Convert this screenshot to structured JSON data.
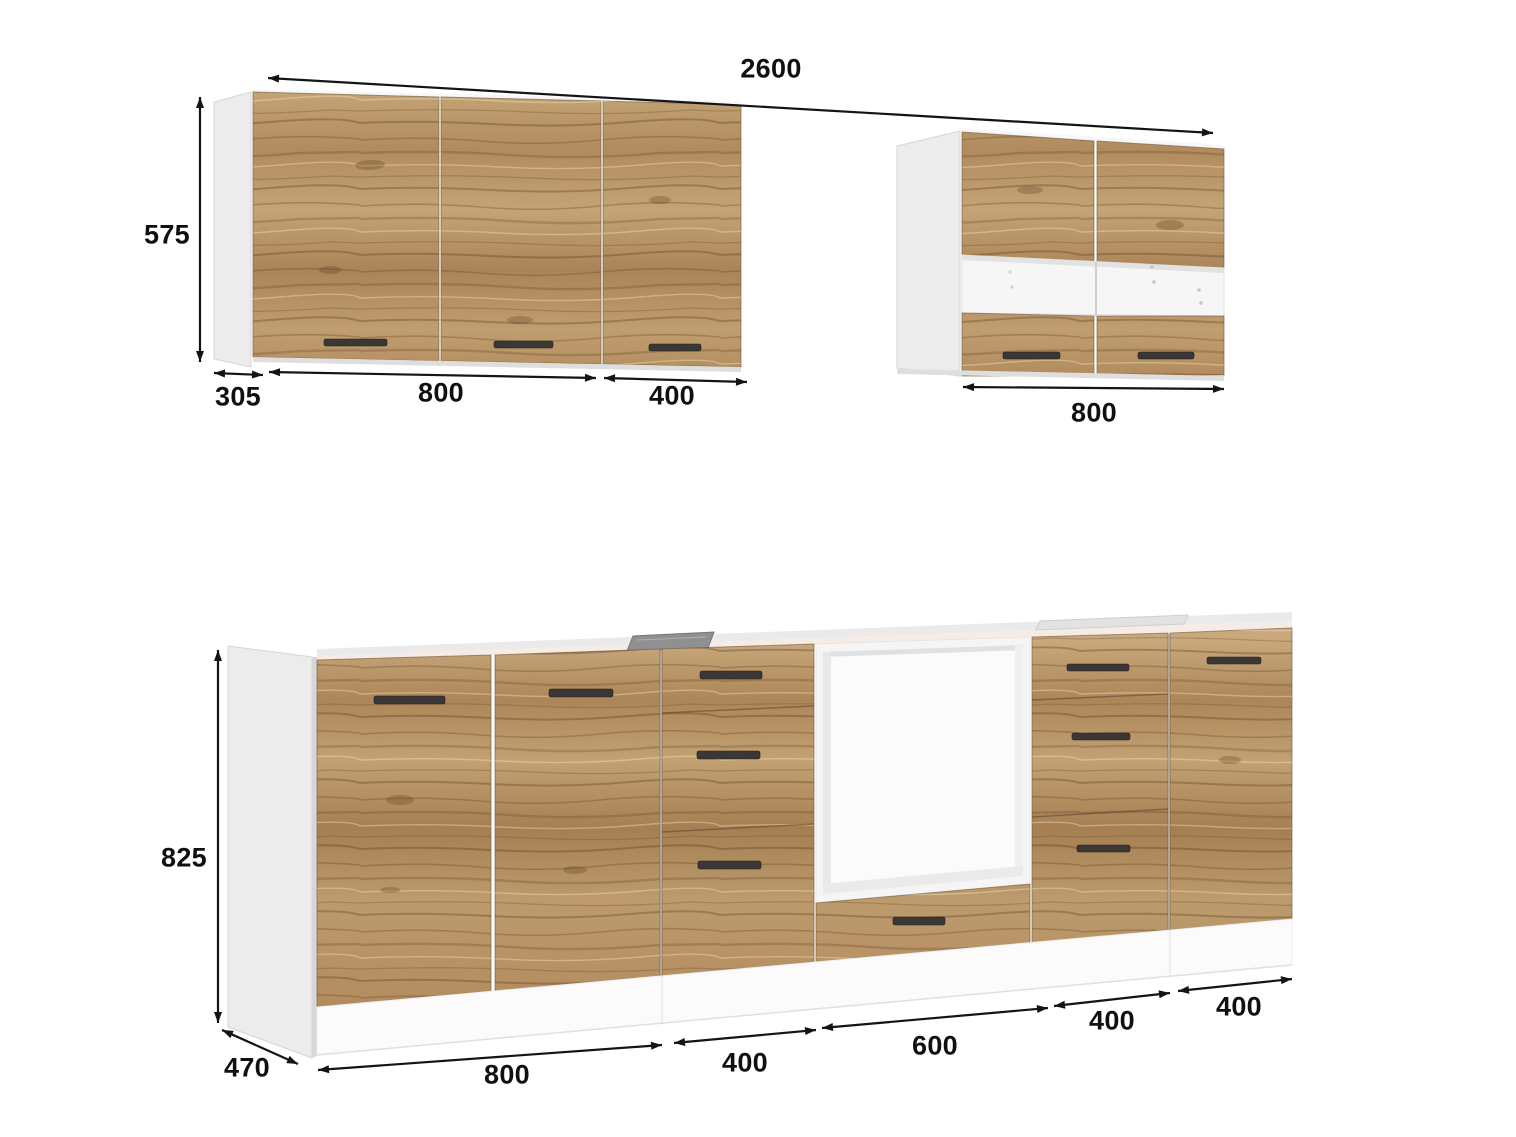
{
  "wall": {
    "total_width": "2600",
    "height": "575",
    "depth": "305",
    "left_two_door_width": "800",
    "left_single_door_width": "400",
    "right_cabinet_width": "800"
  },
  "base": {
    "height": "825",
    "depth": "470",
    "two_door_width": "800",
    "drawers_left_width": "400",
    "oven_unit_width": "600",
    "drawers_right_width": "400",
    "single_door_width": "400"
  },
  "colors": {
    "background": "#ffffff",
    "wood_light": "#c7a779",
    "wood_mid": "#b08a5c",
    "wood_dark": "#8a6a45",
    "carcass_white": "#ececec",
    "countertop_edge": "#f6ece5",
    "hob_gray": "#8f9092",
    "handle": "#3a3734",
    "dimension_text": "#111111"
  }
}
